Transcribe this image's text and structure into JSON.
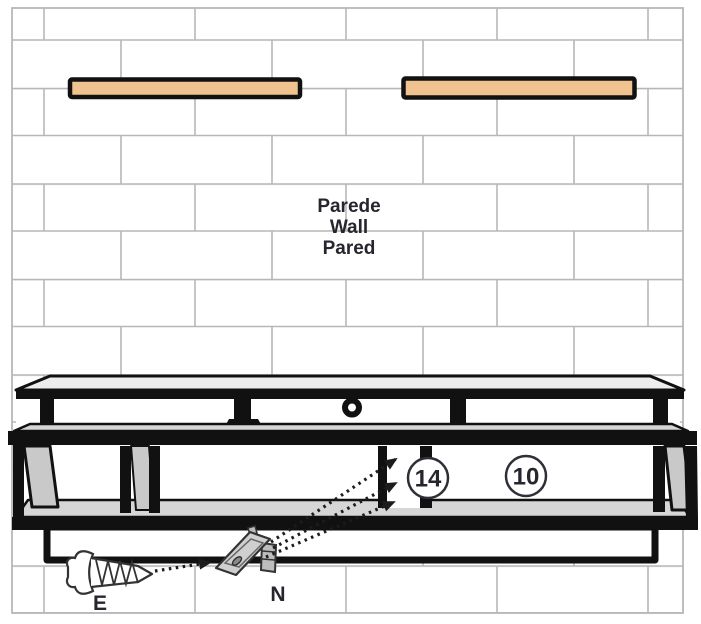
{
  "diagram": {
    "wall_label": {
      "line1": "Parede",
      "line2": "Wall",
      "line3": "Pared"
    },
    "callouts": {
      "part14": "14",
      "part10": "10"
    },
    "hardware": {
      "screw_label": "E",
      "bracket_label": "N"
    },
    "colors": {
      "wood": "#f0c28f",
      "brick_line": "#b7b7b7",
      "panel_gray": "#c9c9c9",
      "surface_gray": "#d6d6d6",
      "outline_black": "#111111",
      "label_ink": "#26262e"
    }
  }
}
